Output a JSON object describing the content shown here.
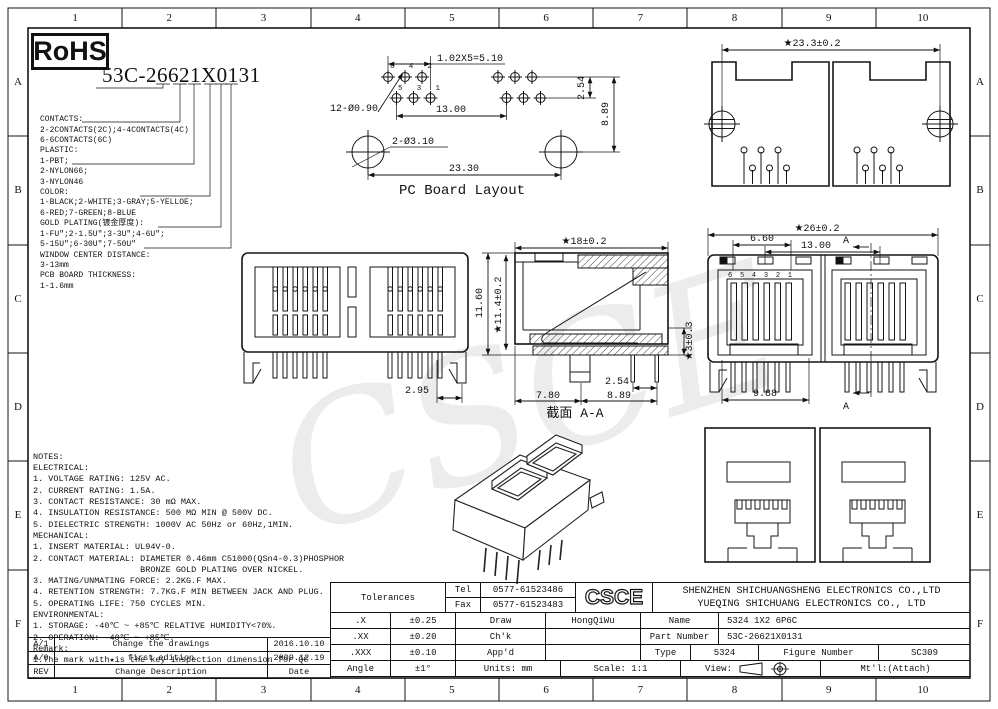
{
  "frame": {
    "cols": [
      "1",
      "2",
      "3",
      "4",
      "5",
      "6",
      "7",
      "8",
      "9",
      "10"
    ],
    "rows": [
      "A",
      "B",
      "C",
      "D",
      "E",
      "F"
    ]
  },
  "rohs_label": "RoHS",
  "part_heading": "53C-26621X0131",
  "ordering": {
    "lines": [
      "CONTACTS:",
      "2-2CONTACTS(2C);4-4CONTACTS(4C)",
      "6-6CONTACTS(6C)",
      "PLASTIC:",
      "1-PBT;",
      "2-NYLON66;",
      "3-NYLON46",
      "COLOR:",
      "1-BLACK;2-WHITE;3-GRAY;5-YELLOE;",
      "6-RED;7-GREEN;8-BLUE",
      "GOLD PLATING(镀金厚度):",
      "1-FU″;2-1.5U″;3-3U″;4-6U″;",
      "5-15U″;6-30U″;7-50U″",
      "WINDOW CENTER DISTANCE:",
      "3-13mm",
      "PCB BOARD THICKNESS:",
      "1-1.6mm"
    ]
  },
  "notes": {
    "lines": [
      "NOTES:",
      "ELECTRICAL:",
      "1. VOLTAGE RATING: 125V AC.",
      "2. CURRENT RATING: 1.5A.",
      "3. CONTACT RESISTANCE: 30 mΩ MAX.",
      "4. INSULATION RESISTANCE: 500 MΩ MIN @ 500V DC.",
      "5. DIELECTRIC STRENGTH: 1000V AC 50Hz or 60Hz,1MIN.",
      "MECHANICAL:",
      "1. INSERT MATERIAL: UL94V-0.",
      "2. CONTACT MATERIAL: DIAMETER 0.46mm C51000(QSn4-0.3)PHOSPHOR",
      "                     BRONZE GOLD PLATING OVER NICKEL.",
      "3. MATING/UNMATING FORCE: 2.2KG.F MAX.",
      "4. RETENTION STRENGTH: 7.7KG.F MIN BETWEEN JACK AND PLUG.",
      "5. OPERATING LIFE: 750 CYCLES MIN.",
      "ENVIRONMENTAL:",
      "1. STORAGE: -40℃ ~ +85℃ RELATIVE HUMIDITY<70%.",
      "2. OPERATION: -40℃ ~ +85℃.",
      "Remark:",
      "1.The mark with★is the key inspection dimension for QC"
    ]
  },
  "pcb": {
    "caption": "PC Board Layout",
    "dim_pitch": "1.02X5=5.10",
    "dim_holes": "12-Ø0.90",
    "dim_13": "13.00",
    "dim_254": "2.54",
    "dim_889": "8.89",
    "dim_mount": "2-Ø3.10",
    "dim_2330": "23.30",
    "pins_top": [
      "6",
      "4",
      "2"
    ],
    "pins_bottom": [
      "5",
      "3",
      "1"
    ]
  },
  "top_view": {
    "dim_width": "★23.3±0.2"
  },
  "front_left": {
    "dim": "2.95"
  },
  "section": {
    "dim_top": "★18±0.2",
    "dim_h_outer": "11.60",
    "dim_h_inner": "★11.4±0.2",
    "dim_standoff": "★3±0.3",
    "dim_780": "7.80",
    "dim_254": "2.54",
    "dim_889": "8.89",
    "caption": "截面  A-A"
  },
  "front_right": {
    "dim_top": "★26±0.2",
    "dim_660": "6.60",
    "dim_1300": "13.00",
    "dim_988": "9.88",
    "pins": [
      "6",
      "5",
      "4",
      "3",
      "2",
      "1"
    ],
    "section_mark_top": "A",
    "section_mark_bottom": "A"
  },
  "watermark": "CSCE",
  "revisions": {
    "rows": [
      {
        "rev": "A/1",
        "desc": "Change the drawings",
        "date": "2016.10.10"
      },
      {
        "rev": "A/0",
        "desc": "first edition",
        "date": "2009.12.19"
      },
      {
        "rev": "REV",
        "desc": "Change Description",
        "date": "Date"
      }
    ]
  },
  "title_block": {
    "tolerances_label": "Tolerances",
    "tol_rows": [
      {
        "k": ".X",
        "v": "±0.25"
      },
      {
        "k": ".XX",
        "v": "±0.20"
      },
      {
        "k": ".XXX",
        "v": "±0.10"
      },
      {
        "k": "Angle",
        "v": "±1°"
      }
    ],
    "tel_label": "Tel",
    "tel": "0577-61523486",
    "fax_label": "Fax",
    "fax": "0577-61523483",
    "logo": "CSCE",
    "company1": "SHENZHEN SHICHUANGSHENG ELECTRONICS CO.,LTD",
    "company2": "YUEQING SHICHUANG ELECTRONICS CO., LTD",
    "draw_label": "Draw",
    "draw": "HongQiWu",
    "chk_label": "Ch'k",
    "chk": "",
    "appd_label": "App'd",
    "appd": "",
    "name_label": "Name",
    "name": "5324 1X2 6P6C",
    "part_label": "Part Number",
    "part": "53C-26621X0131",
    "type_label": "Type",
    "type": "5324",
    "figure_label": "Figure Number",
    "figure": "SC309",
    "units": "Units: mm",
    "scale": "Scale: 1:1",
    "view_label": "View:",
    "mtl": "Mt'l:(Attach)"
  }
}
